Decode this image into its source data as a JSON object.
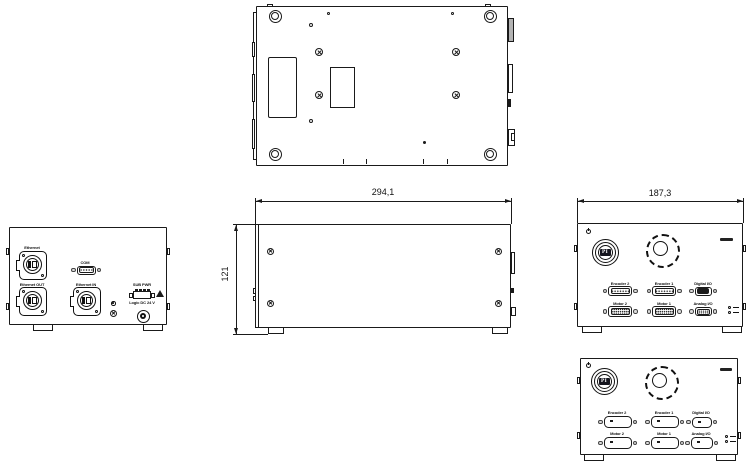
{
  "title": "Multi-view technical drawing of a benchtop motion-controller enclosure",
  "colors": {
    "line": "#1a1a1a",
    "bg": "#ffffff",
    "shade": "#b3b3b3"
  },
  "dimensions": {
    "depth_mm": "294,1",
    "height_mm": "121",
    "width_mm": "187,3"
  },
  "rear_panel": {
    "ethernet": "Ethernet",
    "com": "COM",
    "ethernet_out": "Ethernet OUT",
    "ethernet_in": "Ethernet IN",
    "sub_pwr": "SUB PWR",
    "logic_dc": "Logic DC 24 V"
  },
  "front_panel": {
    "logo": "PI",
    "row1": [
      "Encoder 2",
      "Encoder 1",
      "Digital I/O"
    ],
    "row2": [
      "Motor 2",
      "Motor 1",
      "Analog I/O"
    ]
  }
}
